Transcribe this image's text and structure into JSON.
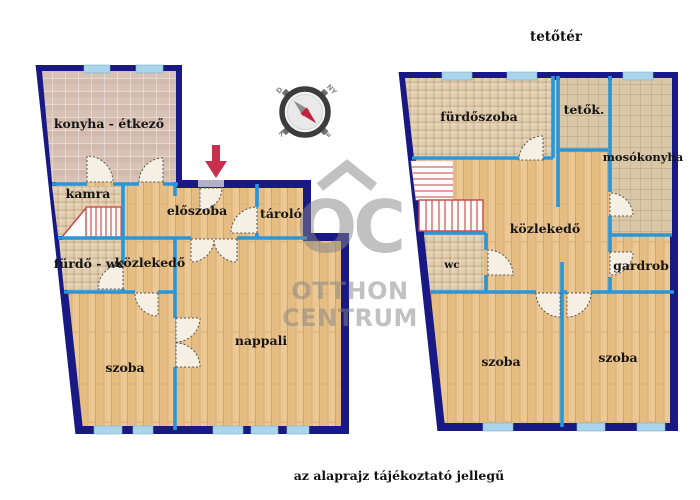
{
  "page": {
    "caption": "az alaprajz tájékoztató jellegű",
    "background": "#ffffff"
  },
  "branding": {
    "logo_monogram": "OC",
    "logo_line1": "OTTHON",
    "logo_line2": "CENTRUM",
    "watermark_color": "#c6c6c6"
  },
  "compass": {
    "north": "É",
    "south": "D",
    "east": "K",
    "west": "NY",
    "needle_north_color": "#c41f3e",
    "needle_south_color": "#8c8c8c"
  },
  "colors": {
    "outer_wall": "#191985",
    "partition_wall": "#2996d9",
    "window": "#aad5ea",
    "wood_floor": "#e9c58d",
    "kitchen_tile": "#d8c2b5",
    "mosaic_tile": "#d6bd9b",
    "grid_tile": "#dac7a7",
    "stair_red": "#cc4444",
    "entrance_arrow": "#c8304e",
    "door_leaf": "#f6efe3"
  },
  "floor_ground": {
    "rooms": [
      {
        "label": "konyha - étkező"
      },
      {
        "label": "kamra"
      },
      {
        "label": "előszoba"
      },
      {
        "label": "tároló"
      },
      {
        "label": "fürdő - wc"
      },
      {
        "label": "közlekedő"
      },
      {
        "label": "szoba"
      },
      {
        "label": "nappali"
      }
    ]
  },
  "floor_attic": {
    "title": "tetőtér",
    "rooms": [
      {
        "label": "fürdőszoba"
      },
      {
        "label": "tetők."
      },
      {
        "label": "mosókonyha"
      },
      {
        "label": "közlekedő"
      },
      {
        "label": "wc"
      },
      {
        "label": "gardrob"
      },
      {
        "label": "szoba"
      },
      {
        "label": "szoba"
      }
    ]
  }
}
